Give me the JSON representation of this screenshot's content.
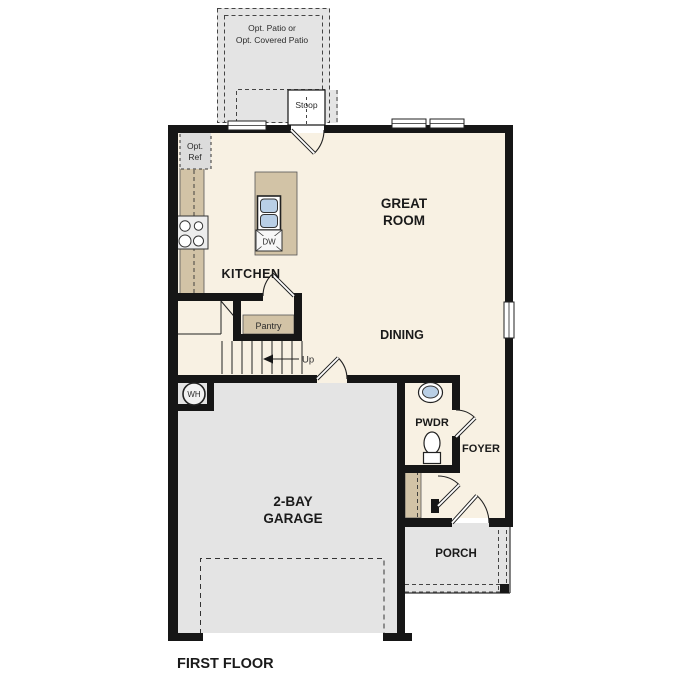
{
  "plan": {
    "floor_title": "FIRST FLOOR",
    "rooms": {
      "great_room_line1": "GREAT",
      "great_room_line2": "ROOM",
      "kitchen": "KITCHEN",
      "dining": "DINING",
      "garage_line1": "2-BAY",
      "garage_line2": "GARAGE",
      "powder": "PWDR",
      "foyer": "FOYER",
      "porch": "PORCH",
      "pantry": "Pantry",
      "stoop": "Stoop"
    },
    "annotations": {
      "opt_patio_line1": "Opt. Patio or",
      "opt_patio_line2": "Opt. Covered Patio",
      "opt_ref_line1": "Opt.",
      "opt_ref_line2": "Ref",
      "stairs_up": "Up",
      "water_heater": "WH",
      "dishwasher": "DW"
    },
    "colors": {
      "floor_cream": "#f8f1e3",
      "concrete_gray": "#e4e4e4",
      "wall_black": "#161616",
      "casework_tan": "#d2c3a6",
      "fixture_blue": "#b9cfe6",
      "appliance_gray": "#dcdcdc"
    }
  }
}
